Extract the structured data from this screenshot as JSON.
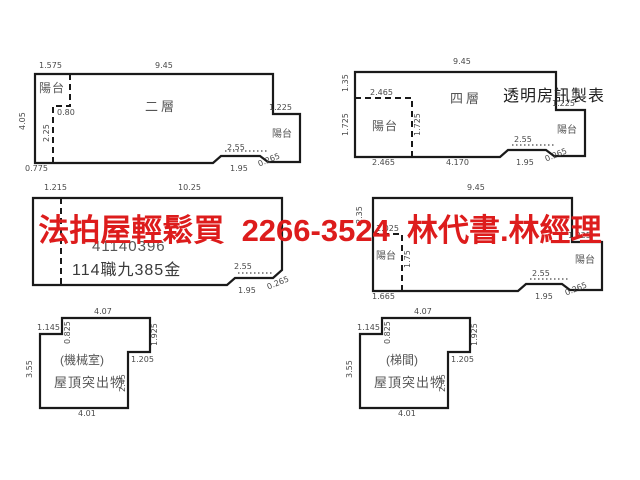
{
  "watermark": {
    "text": "法拍屋輕鬆買  2266-3524  林代書.林經理",
    "color": "#dd1c1c"
  },
  "credit": {
    "text": "透明房訊製表"
  },
  "colors": {
    "line": "#1a1a1a",
    "dim_text": "#4a4a4a"
  },
  "plans": {
    "floor2": {
      "name_label": "二層",
      "balcony_left": "陽台",
      "balcony_right": "陽台",
      "dim_top_left": "1.575",
      "dim_top": "9.45",
      "dim_left": "4.05",
      "dim_inner_h": "0.80",
      "dim_inner_v": "2.25",
      "dim_bottom_left": "0.775",
      "dim_right_step": "1.225",
      "dim_notch_w": "2.55",
      "dim_notch_w2": "1.95",
      "dim_notch_d": "0.265"
    },
    "floor4": {
      "name_label": "四層",
      "balcony_left": "陽台",
      "balcony_right": "陽台",
      "dim_top": "9.45",
      "dim_left_top": "1.35",
      "dim_left": "1.725",
      "dim_balcony_top": "2.465",
      "dim_inner_v": "1.725",
      "dim_bottom_left": "2.465",
      "dim_bottom_mid": "4.170",
      "dim_right_step": "1.225",
      "dim_notch_w": "2.55",
      "dim_notch_w2": "1.95",
      "dim_notch_d": "0.265"
    },
    "middle_left": {
      "serial": "41140396",
      "case_no": "114職九385金",
      "dim_top_left": "1.215",
      "dim_top": "10.25",
      "dim_notch_w": "2.55",
      "dim_notch_w2": "1.95",
      "dim_notch_d": "0.265"
    },
    "middle_right": {
      "balcony_left": "陽台",
      "balcony_right": "陽台",
      "dim_top": "9.45",
      "dim_left_top": "2.35",
      "dim_balcony_top": "1.025",
      "dim_inner_v": "1.75",
      "dim_bottom_left": "1.665",
      "dim_right_step": "1.225",
      "dim_notch_w": "2.55",
      "dim_notch_w2": "1.95",
      "dim_notch_d": "0.265"
    },
    "roof_left": {
      "room_label": "(機械室)",
      "type_label": "屋頂突出物",
      "dim_top": "4.07",
      "dim_top_left": "1.145",
      "dim_top_inner": "0.825",
      "dim_right_top": "1.925",
      "dim_right_mid": "1.205",
      "dim_right_low": "2.45",
      "dim_left": "3.55",
      "dim_bottom": "4.01"
    },
    "roof_right": {
      "room_label": "(梯間)",
      "type_label": "屋頂突出物",
      "dim_top": "4.07",
      "dim_top_left": "1.145",
      "dim_top_inner": "0.825",
      "dim_right_top": "1.925",
      "dim_right_mid": "1.205",
      "dim_right_low": "2.45",
      "dim_left": "3.55",
      "dim_bottom": "4.01"
    }
  }
}
